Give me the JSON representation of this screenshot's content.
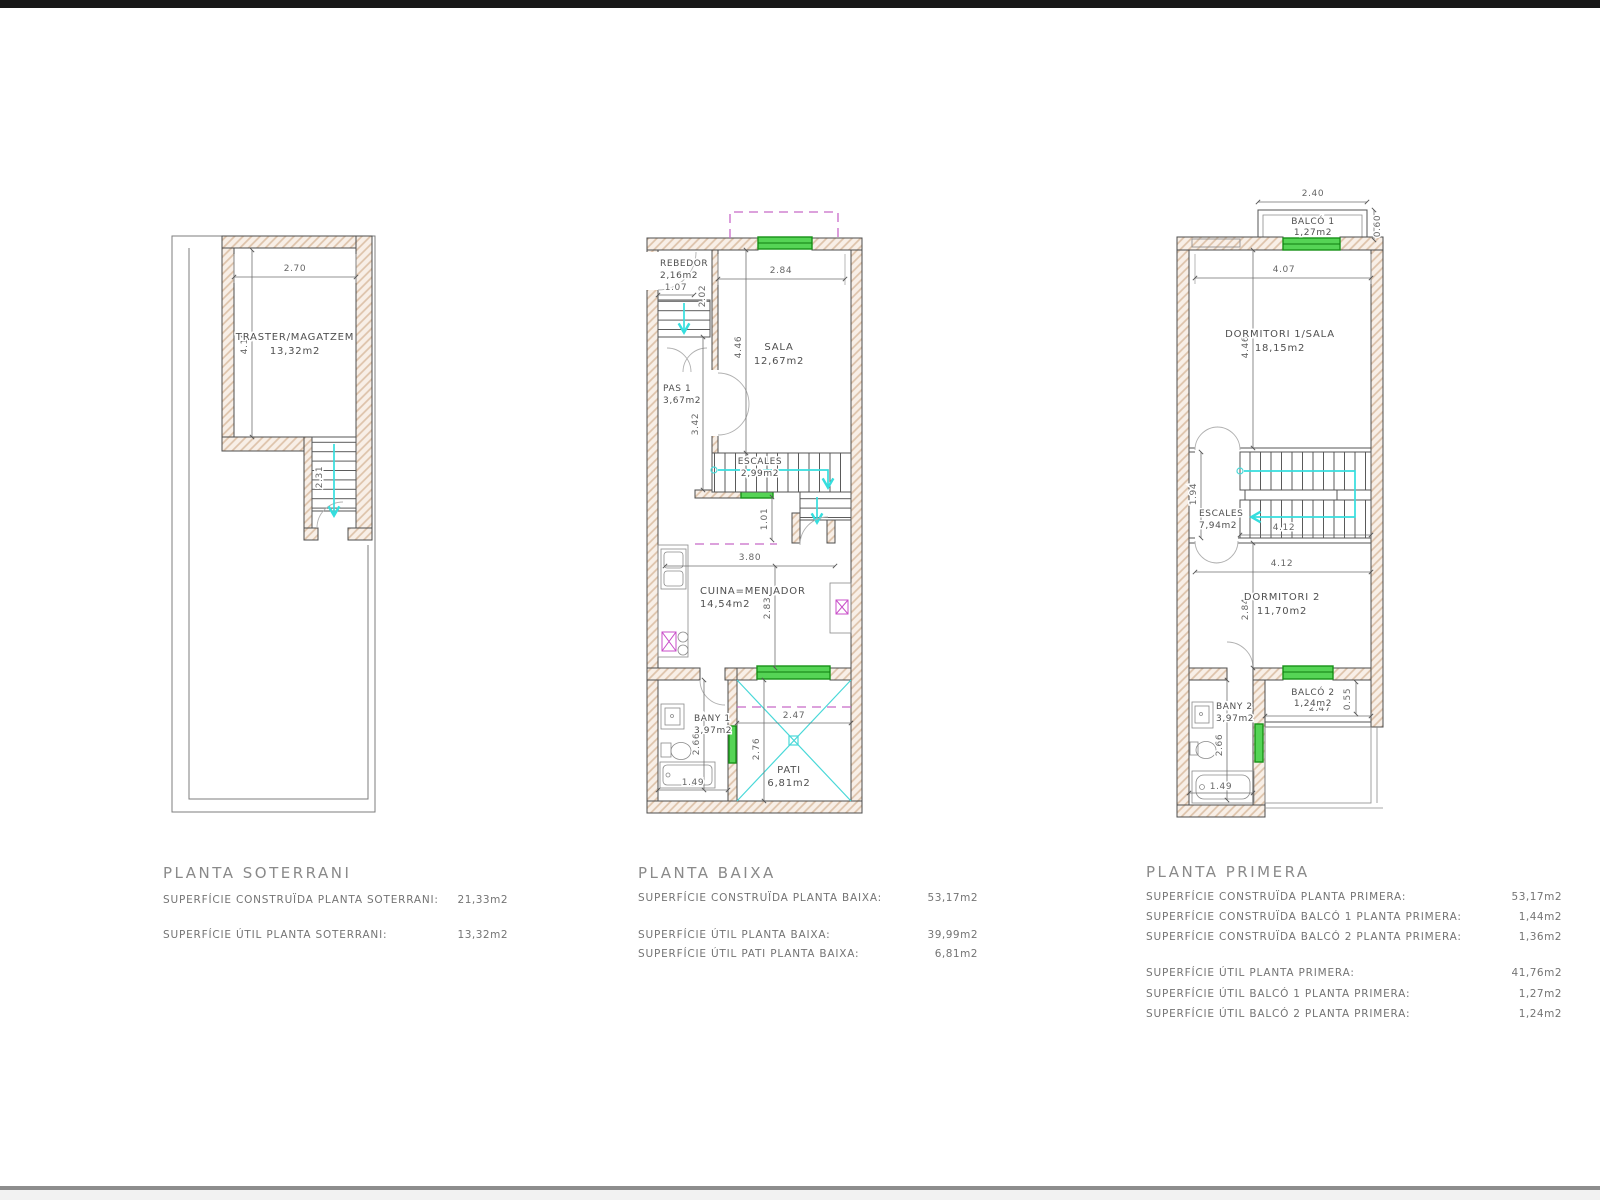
{
  "colors": {
    "wall_hatch": "#ddc2a9",
    "window_green": "#55d455",
    "stair_cyan": "#35dede",
    "projection_magenta": "#c869c8",
    "appliance_magenta": "#c94fc9",
    "line_gray": "#4d4d4d"
  },
  "soterrani": {
    "title": "PLANTA SOTERRANI",
    "room": {
      "name": "TRASTER/MAGATZEM",
      "area": "13,32m2"
    },
    "dims": {
      "width": "2.70",
      "height": "4.19",
      "stairs": "2.31"
    },
    "summary": [
      {
        "label": "SUPERFÍCIE CONSTRUÏDA PLANTA SOTERRANI:",
        "value": "21,33m2"
      },
      {
        "label": "SUPERFÍCIE ÚTIL PLANTA SOTERRANI:",
        "value": "13,32m2"
      }
    ]
  },
  "baixa": {
    "title": "PLANTA BAIXA",
    "rooms": {
      "rebedor": {
        "name": "REBEDOR",
        "area": "2,16m2"
      },
      "sala": {
        "name": "SALA",
        "area": "12,67m2"
      },
      "pas": {
        "name": "PAS 1",
        "area": "3,67m2"
      },
      "escales": {
        "name": "ESCALES",
        "area": "2,99m2"
      },
      "cuina": {
        "name": "CUINA=MENJADOR",
        "area": "14,54m2"
      },
      "bany": {
        "name": "BANY 1",
        "area": "3,97m2"
      },
      "pati": {
        "name": "PATI",
        "area": "6,81m2"
      }
    },
    "dims": {
      "rebedor_w": "1.07",
      "rebedor_h": "2.02",
      "sala_w": "2.84",
      "sala_h": "4.46",
      "pas_h": "3.42",
      "landing": "1.01",
      "cuina_w": "3.80",
      "cuina_h": "2.83",
      "bany_h": "2.66",
      "bany_w": "1.49",
      "pati_w": "2.47",
      "pati_h": "2.76"
    },
    "summary": [
      {
        "label": "SUPERFÍCIE CONSTRUÏDA PLANTA BAIXA:",
        "value": "53,17m2"
      },
      {
        "label": "SUPERFÍCIE ÚTIL PLANTA BAIXA:",
        "value": "39,99m2"
      },
      {
        "label": "SUPERFÍCIE ÚTIL PATI PLANTA BAIXA:",
        "value": "6,81m2"
      }
    ]
  },
  "primera": {
    "title": "PLANTA PRIMERA",
    "rooms": {
      "balco1": {
        "name": "BALCÓ 1",
        "area": "1,27m2"
      },
      "dorm1": {
        "name": "DORMITORI 1/SALA",
        "area": "18,15m2"
      },
      "escales": {
        "name": "ESCALES",
        "area": "7,94m2"
      },
      "dorm2": {
        "name": "DORMITORI 2",
        "area": "11,70m2"
      },
      "bany2": {
        "name": "BANY 2",
        "area": "3,97m2"
      },
      "balco2": {
        "name": "BALCÓ 2",
        "area": "1,24m2"
      }
    },
    "dims": {
      "balco1_w": "2.40",
      "balco1_d": "0.60",
      "dorm1_w": "4.07",
      "dorm1_h": "4.46",
      "escales_h": "1.94",
      "stair_w": "4.12",
      "dorm2_w": "4.12",
      "dorm2_h": "2.84",
      "bany2_h": "2.66",
      "bany2_w": "1.49",
      "balco2_w": "2.47",
      "balco2_d": "0.55"
    },
    "summary": [
      {
        "label": "SUPERFÍCIE CONSTRUÏDA PLANTA PRIMERA:",
        "value": "53,17m2"
      },
      {
        "label": "SUPERFÍCIE CONSTRUÏDA BALCÓ 1 PLANTA PRIMERA:",
        "value": "1,44m2"
      },
      {
        "label": "SUPERFÍCIE CONSTRUÏDA BALCÓ 2 PLANTA PRIMERA:",
        "value": "1,36m2"
      },
      {
        "label": "SUPERFÍCIE ÚTIL PLANTA PRIMERA:",
        "value": "41,76m2"
      },
      {
        "label": "SUPERFÍCIE ÚTIL BALCÓ 1 PLANTA PRIMERA:",
        "value": "1,27m2"
      },
      {
        "label": "SUPERFÍCIE ÚTIL BALCÓ 2 PLANTA PRIMERA:",
        "value": "1,24m2"
      }
    ]
  }
}
